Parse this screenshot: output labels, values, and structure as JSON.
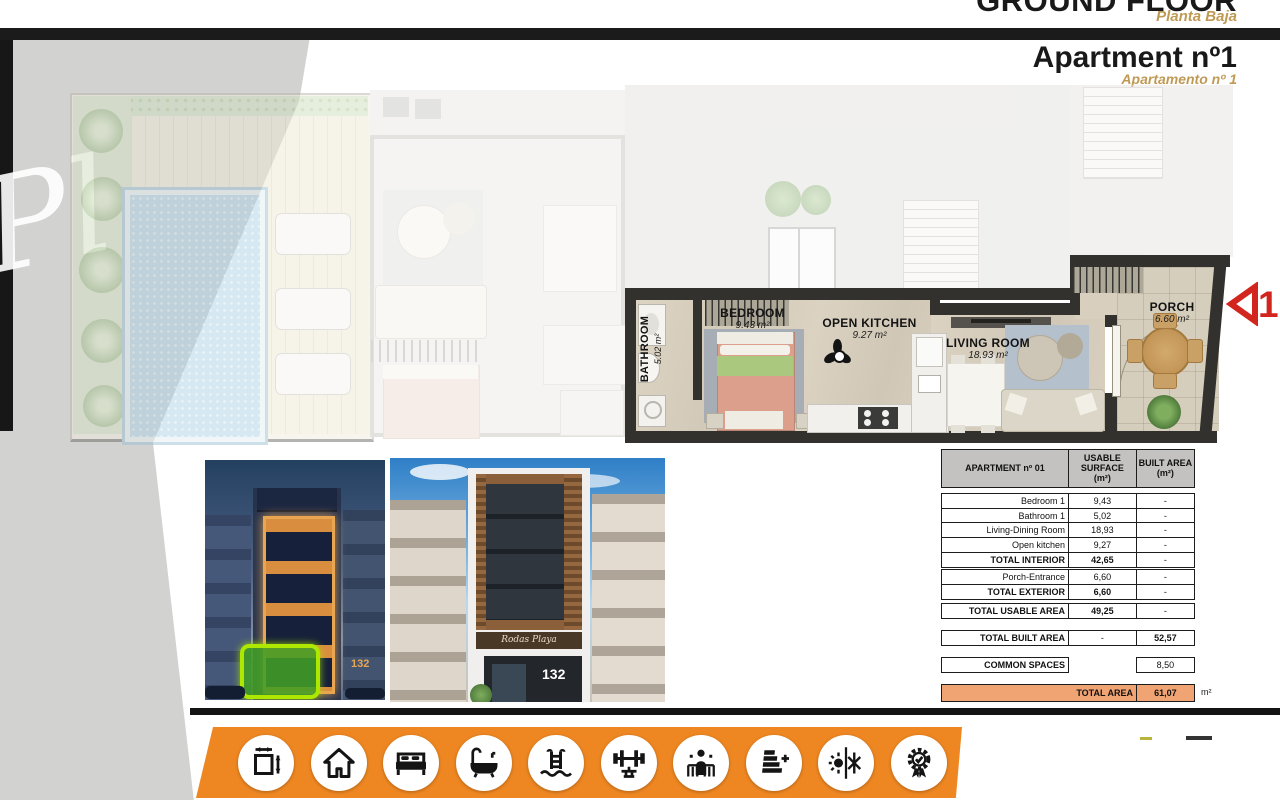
{
  "header": {
    "title_en": "GROUND FLOOR",
    "title_es": "Planta Baja",
    "apartment_en": "Apartment nº1",
    "apartment_es": "Apartamento nº 1"
  },
  "floor_plan": {
    "watermark": "Pl",
    "unit_marker": "1",
    "rooms": [
      {
        "name": "BATHROOM",
        "area": "5.02 m²"
      },
      {
        "name": "BEDROOM",
        "area": "9.43 m²"
      },
      {
        "name": "OPEN KITCHEN",
        "area": "9.27 m²"
      },
      {
        "name": "LIVING ROOM",
        "area": "18.93 m²"
      },
      {
        "name": "PORCH",
        "area": "6.60 m²"
      }
    ]
  },
  "renders": [
    {
      "name": "night-facade",
      "street_number": "132"
    },
    {
      "name": "day-facade",
      "street_number": "132",
      "sign": "Rodas Playa"
    }
  ],
  "area_table": {
    "header": {
      "col1": "APARTMENT nº 01",
      "col2": "USABLE SURFACE",
      "col3": "BUILT AREA",
      "unit": "(m²)"
    },
    "interior": [
      {
        "l": "Bedroom 1",
        "u": "9,43",
        "b": "-"
      },
      {
        "l": "Bathroom 1",
        "u": "5,02",
        "b": "-"
      },
      {
        "l": "Living-Dining Room",
        "u": "18,93",
        "b": "-"
      },
      {
        "l": "Open kitchen",
        "u": "9,27",
        "b": "-"
      },
      {
        "l": "TOTAL INTERIOR",
        "u": "42,65",
        "b": "-"
      }
    ],
    "exterior": [
      {
        "l": "Porch-Entrance",
        "u": "6,60",
        "b": "-"
      },
      {
        "l": "TOTAL EXTERIOR",
        "u": "6,60",
        "b": "-"
      }
    ],
    "total_usable": {
      "l": "TOTAL USABLE AREA",
      "u": "49,25",
      "b": "-"
    },
    "total_built": {
      "l": "TOTAL BUILT AREA",
      "u": "-",
      "b": "52,57"
    },
    "common_spaces": {
      "l": "COMMON SPACES",
      "b": "8,50"
    },
    "total_area": {
      "l": "TOTAL AREA",
      "v": "61,07"
    },
    "unit_suffix": "m²"
  },
  "amenity_icons": [
    "floor-dimensions",
    "house",
    "bedroom",
    "bathtub",
    "swimming-pool",
    "gym",
    "spa-person",
    "energy-rating",
    "climate-control",
    "quality-award"
  ],
  "colors": {
    "accent_tan": "#bf9a55",
    "orange_bar": "#ee8722",
    "table_total_bg": "#f0a373",
    "highlight_green_border": "#aee800",
    "marker_red": "#d2251d"
  }
}
